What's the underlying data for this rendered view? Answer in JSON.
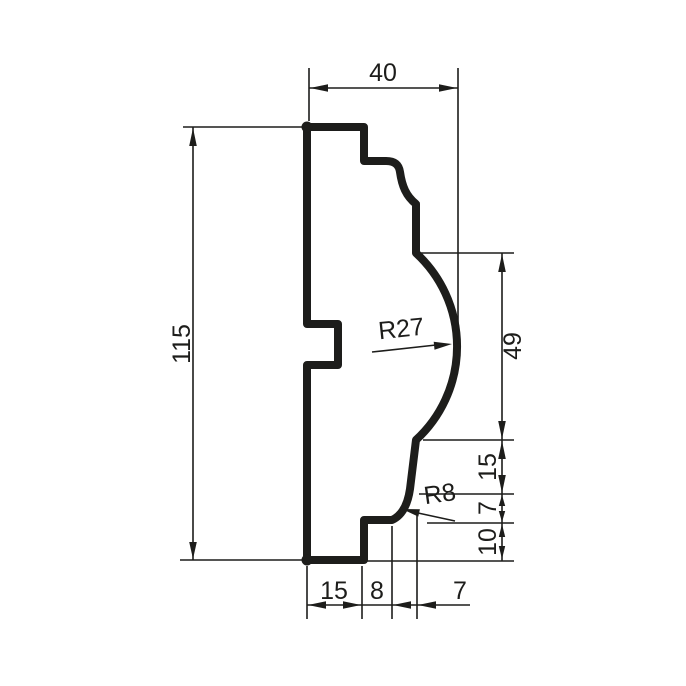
{
  "drawing": {
    "type": "technical-profile-cross-section",
    "background": "#ffffff",
    "line_color": "#1d1d1b",
    "labels": {
      "top_width": "40",
      "overall_height": "115",
      "radius_cove": "R27",
      "cove_height": "49",
      "right_upper": "15",
      "radius_fillet": "R8",
      "right_mid": "7",
      "right_lower": "10",
      "bottom_back": "15",
      "bottom_step": "8",
      "bottom_front": "7"
    }
  }
}
